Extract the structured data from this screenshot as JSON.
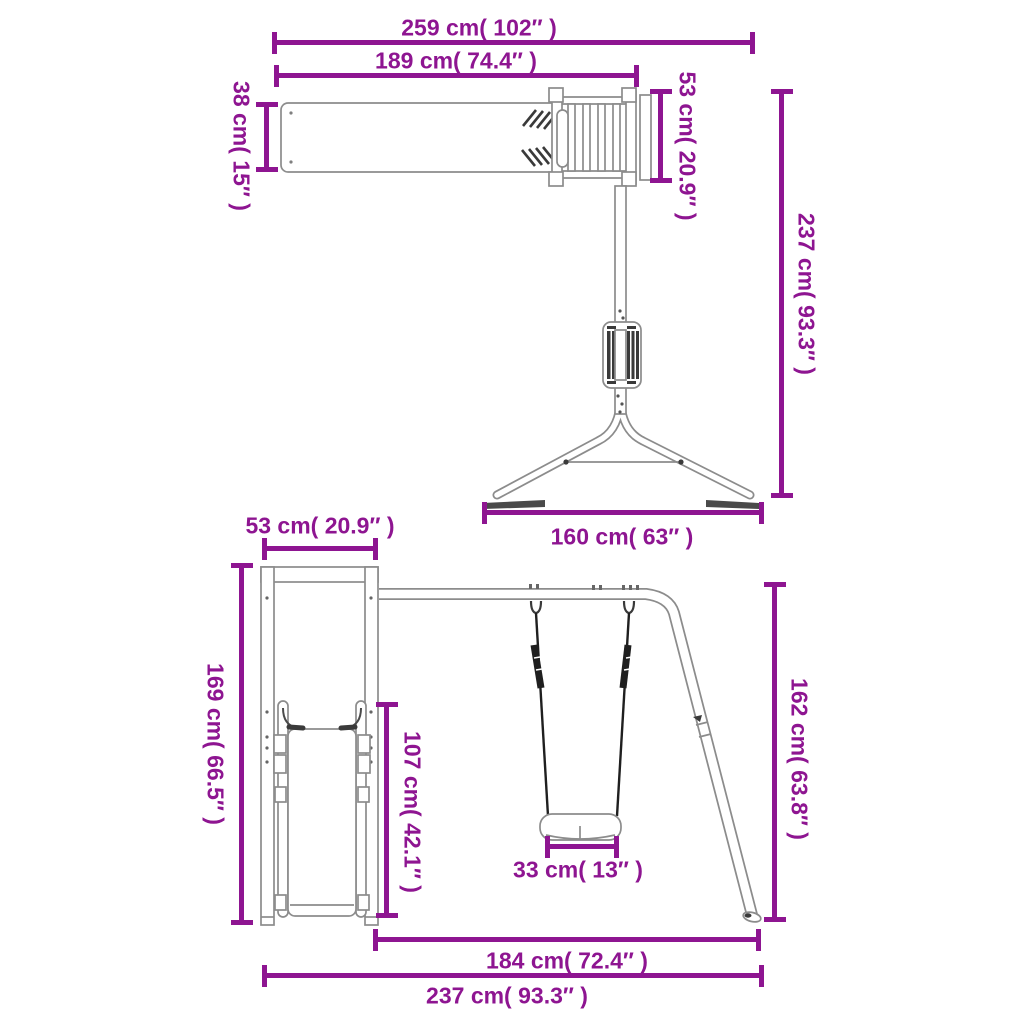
{
  "colors": {
    "dimension": "#8e1591",
    "outline": "#8c8c8c",
    "dark_parts": "#3a3a3a",
    "background": "#ffffff"
  },
  "top_view": {
    "dims": {
      "overall_width": "259 cm( 102″ )",
      "wall_board_width": "189 cm( 74.4″ )",
      "board_depth": "38 cm( 15″ )",
      "ladder_width": "53 cm( 20.9″ )",
      "total_depth": "237 cm( 93.3″ )",
      "feet_spread": "160 cm( 63″ )"
    }
  },
  "front_view": {
    "dims": {
      "tower_depth": "53 cm( 20.9″ )",
      "tower_height": "169 cm( 66.5″ )",
      "slide_height": "107 cm( 42.1″ )",
      "seat_width": "33 cm( 13″ )",
      "swing_height": "162 cm( 63.8″ )",
      "swing_span": "184 cm( 72.4″ )",
      "overall_width": "237 cm( 93.3″ )"
    }
  }
}
